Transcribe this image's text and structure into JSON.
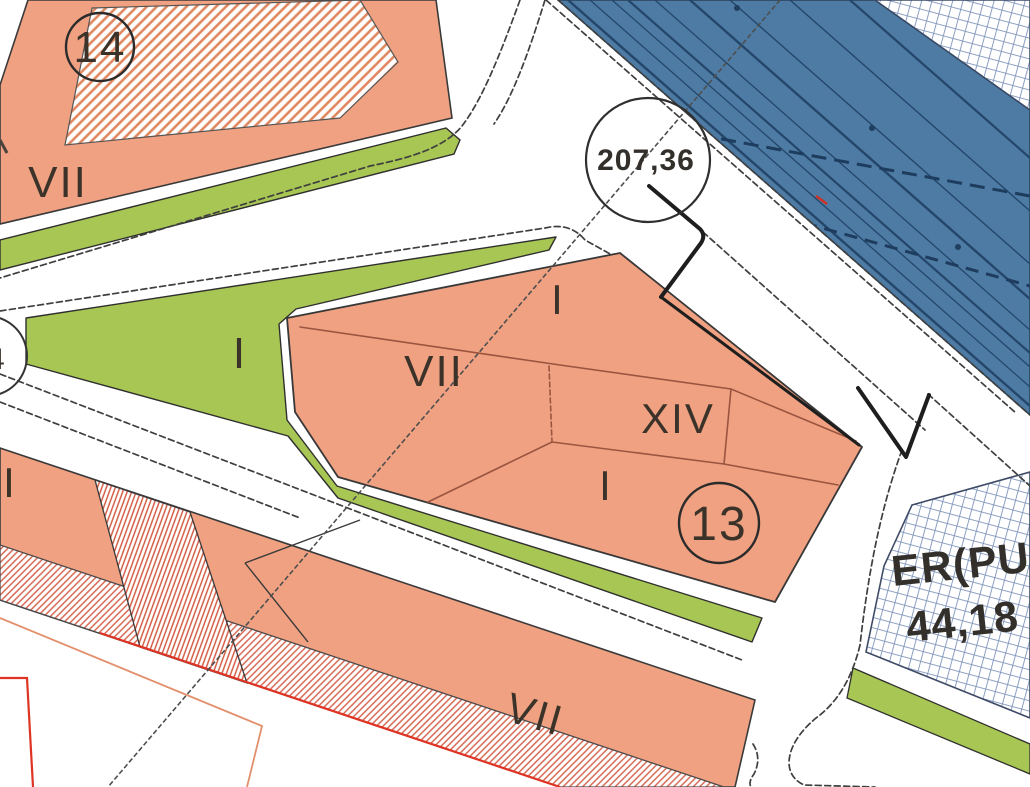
{
  "zones": {
    "block_14": {
      "number": "14",
      "label_vii": "VII"
    },
    "block_13": {
      "number": "13",
      "label_i_top": "I",
      "label_vii": "VII",
      "label_xiv": "XIV",
      "label_i_bottom": "I"
    },
    "green_triangle": {
      "label_i": "I"
    },
    "left_strip": {
      "label_i": "I"
    },
    "bottom_strip": {
      "label_vii": "VII"
    },
    "equipment_parcel": {
      "code": "ER(PU",
      "area_value": "44,18"
    },
    "road_junction": {
      "elevation": "207,36"
    },
    "edge_circle": {
      "number": "4"
    }
  },
  "colors": {
    "parcel_salmon": "#f0a181",
    "hatch_salmon": "#e0875f",
    "hatch_red": "#d4604a",
    "hatch_red_steep": "#d4604a",
    "green_space": "#a8c653",
    "railway_blue": "#4d7ba3",
    "railway_line_dark": "#24466b",
    "railway_dash_dark": "#1d3c5e",
    "grid_line_blue": "#8095bb",
    "outline_dark": "#3a3a3a",
    "red_accent": "#df3424",
    "red_faint": "#e2906c",
    "text_dark": "#3b332a"
  }
}
